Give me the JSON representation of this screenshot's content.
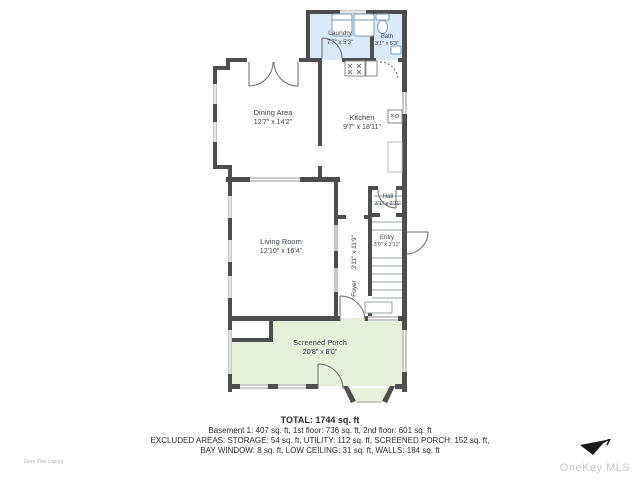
{
  "plan": {
    "rooms": [
      {
        "id": "laundry",
        "name": "Laundry",
        "dims": "7'7\" x 5'3\""
      },
      {
        "id": "bath",
        "name": "Bath",
        "dims": "3'1\" x 5'3\""
      },
      {
        "id": "dining",
        "name": "Dining Area",
        "dims": "12'7\" x 14'2\""
      },
      {
        "id": "kitchen",
        "name": "Kitchen",
        "dims": "9'7\" x 18'11\""
      },
      {
        "id": "hall",
        "name": "Hall",
        "dims": "3'1\" x 2'11\""
      },
      {
        "id": "living",
        "name": "Living Room",
        "dims": "12'10\" x 16'4\""
      },
      {
        "id": "foyer",
        "name": "Foyer",
        "dims": "3'11\" x 11'9\""
      },
      {
        "id": "entry",
        "name": "Entry",
        "dims": "3'0\" x 2'11\""
      },
      {
        "id": "porch",
        "name": "Screened Porch",
        "dims": "20'8\" x 8'0\""
      }
    ],
    "colors": {
      "wall": "#4e4e4e",
      "wet_room_fill": "#d9e9f8",
      "porch_fill": "#e7f0da",
      "window": "#c9c9c9",
      "fixture_stroke": "#7f9db9"
    }
  },
  "summary": {
    "total": "TOTAL: 1744 sq. ft",
    "floors": "Basement 1: 407 sq. ft, 1st floor: 736 sq. ft, 2nd floor: 601 sq. ft",
    "excluded1": "EXCLUDED AREAS: STORAGE: 54 sq. ft, UTILITY: 112 sq. ft, SCREENED PORCH: 152 sq. ft,",
    "excluded2": "BAY WINDOW: 8 sq. ft, LOW CEILING: 31 sq. ft, WALLS: 184 sq. ft"
  },
  "footer": {
    "caption": "Floor Plan Layout",
    "watermark": "OneKey MLS"
  }
}
